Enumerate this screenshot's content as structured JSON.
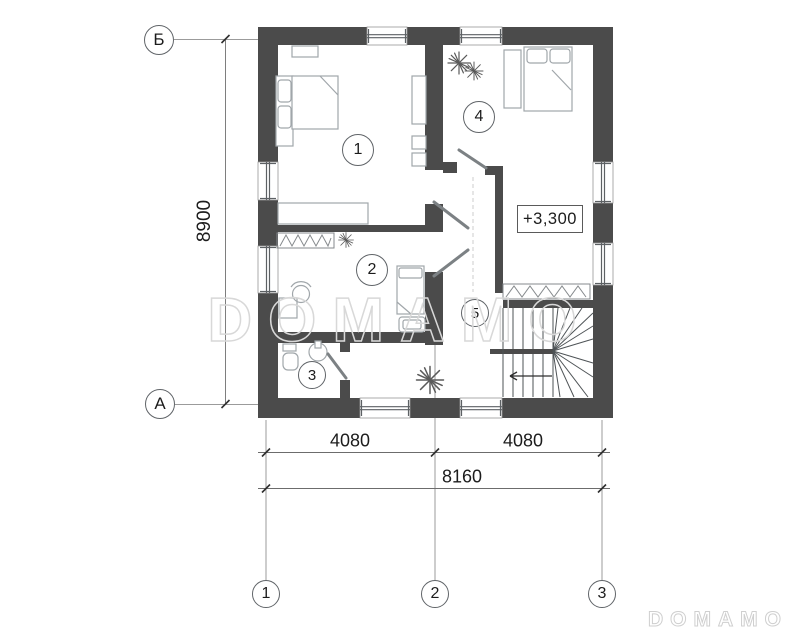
{
  "axes": {
    "row_top": "Б",
    "row_bottom": "А",
    "col_1": "1",
    "col_2": "2",
    "col_3": "3"
  },
  "dimensions": {
    "height_total": "8900",
    "width_left": "4080",
    "width_right": "4080",
    "width_total": "8160"
  },
  "rooms": {
    "r1": "1",
    "r2": "2",
    "r3": "3",
    "r4": "4",
    "r5": "5"
  },
  "elevation": {
    "value": "+3,300"
  },
  "watermark": {
    "large": "DOMAMO",
    "small": "DOMAMO"
  },
  "colors": {
    "wall": "#4b4b4b",
    "furniture_line": "#a0a6aa",
    "axis_line": "#9b9b9b",
    "text": "#1c1c1c",
    "watermark": "#d8d8d8"
  }
}
